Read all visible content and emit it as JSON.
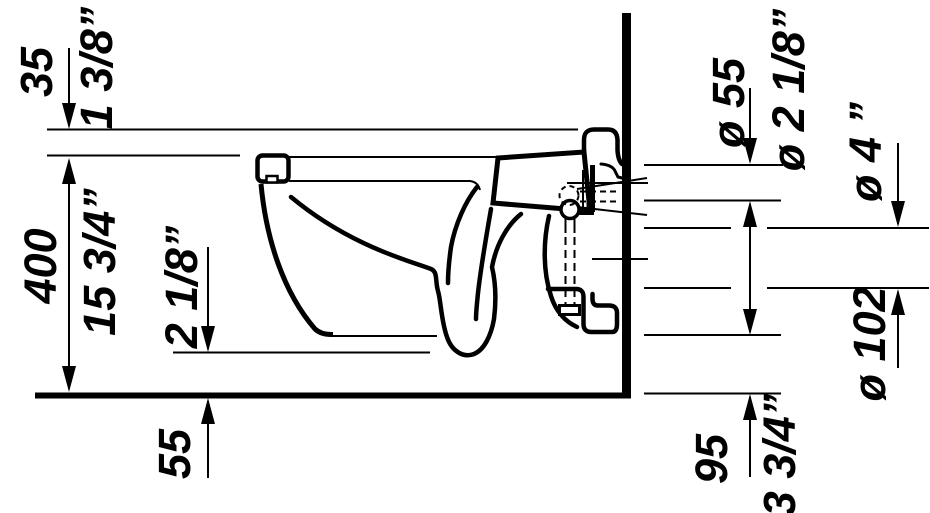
{
  "drawing": {
    "type": "technical-dimension-drawing",
    "subject": "wall-mounted toilet side elevation",
    "colors": {
      "line": "#000000",
      "background": "#ffffff"
    }
  },
  "labels": {
    "seat_height": {
      "metric": "35",
      "imperial": "1 3/8”"
    },
    "rim_height": {
      "metric": "400",
      "imperial": "15 3/4”"
    },
    "trap_clearance": {
      "metric": "55",
      "imperial": "2 1/8”"
    },
    "inlet_diameter": {
      "metric": "ø 55",
      "imperial": "ø 2 1/8”"
    },
    "outlet_diameter": {
      "metric": "ø 102",
      "imperial": "ø 4 ”"
    },
    "outlet_height": {
      "metric": "95",
      "imperial": "3 3/4”"
    }
  }
}
